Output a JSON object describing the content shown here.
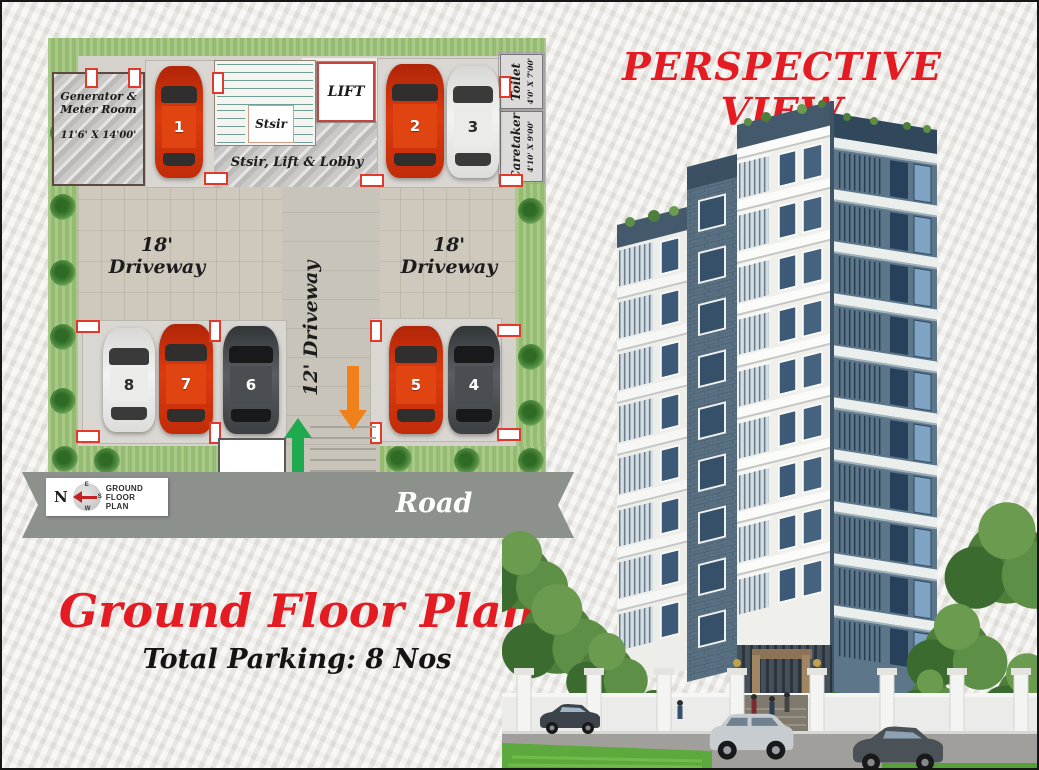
{
  "titles": {
    "perspective_view": "PERSPECTIVE VIEW",
    "plan_title": "Ground Floor Plan",
    "total_parking": "Total Parking:  8 Nos"
  },
  "plan": {
    "generator_room": {
      "line1": "Generator &",
      "line2": "Meter Room",
      "dims": "11'6' X 14'00'"
    },
    "stair_label": "Stsir",
    "lift_label": "LIFT",
    "lobby_label": "Stsir, Lift & Lobby",
    "toilet": {
      "label": "Toilet",
      "dims": "4'0' X 7'00'"
    },
    "caretaker": {
      "label": "Caretaker",
      "dims": "4'10' X 9'00'"
    },
    "driveway_left": "18' Driveway",
    "driveway_right": "18' Driveway",
    "driveway_center": "12' Driveway",
    "road_label": "Road",
    "compass": {
      "n": "N",
      "e": "E",
      "s": "S",
      "w": "W",
      "caption": "GROUND FLOOR PLAN"
    },
    "cars": [
      {
        "no": "1",
        "color": "red"
      },
      {
        "no": "2",
        "color": "red"
      },
      {
        "no": "3",
        "color": "white"
      },
      {
        "no": "4",
        "color": "dark"
      },
      {
        "no": "5",
        "color": "red"
      },
      {
        "no": "6",
        "color": "dark"
      },
      {
        "no": "7",
        "color": "red"
      },
      {
        "no": "8",
        "color": "white"
      }
    ]
  },
  "colors": {
    "accent_red": "#e51b23",
    "arrow_green": "#1faa50",
    "arrow_orange": "#f08019",
    "building_slate": "#5d7689",
    "grass": "#9dc279"
  }
}
